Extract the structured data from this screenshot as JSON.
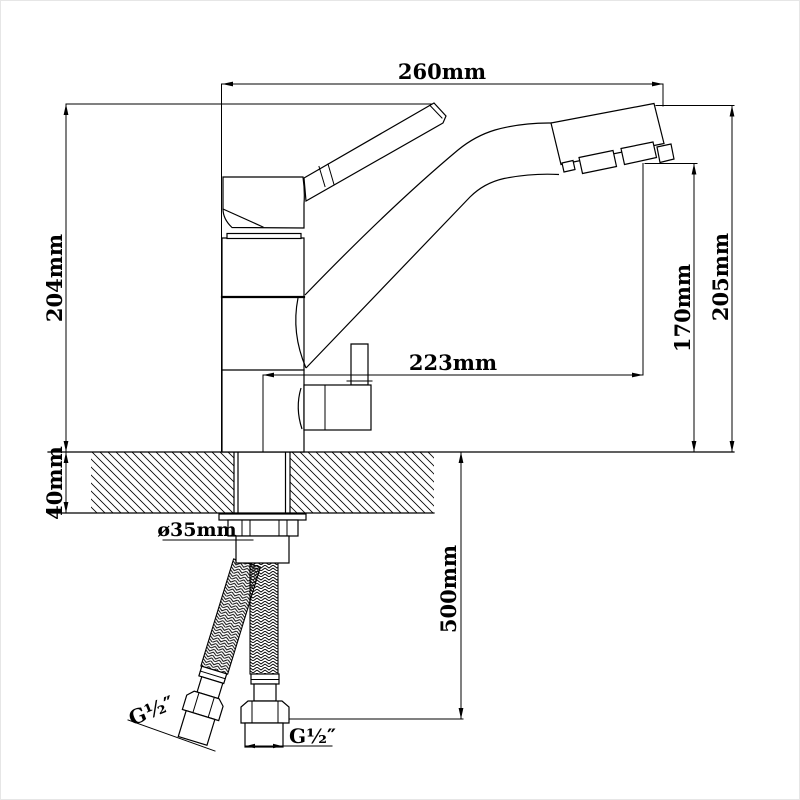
{
  "drawing": {
    "subject": "kitchen-faucet-dimension-drawing",
    "units": "mm",
    "dims": {
      "top_width": "260mm",
      "left_height": "204mm",
      "right_outer_height": "205mm",
      "outlet_height": "170mm",
      "spout_reach": "223mm",
      "counter_thickness": "40mm",
      "hole_diameter": "ø35mm",
      "hose_length": "500mm",
      "thread_angled": "G½″",
      "thread_straight": "G½″"
    },
    "line_color": "#000000",
    "background_color": "#ffffff"
  }
}
